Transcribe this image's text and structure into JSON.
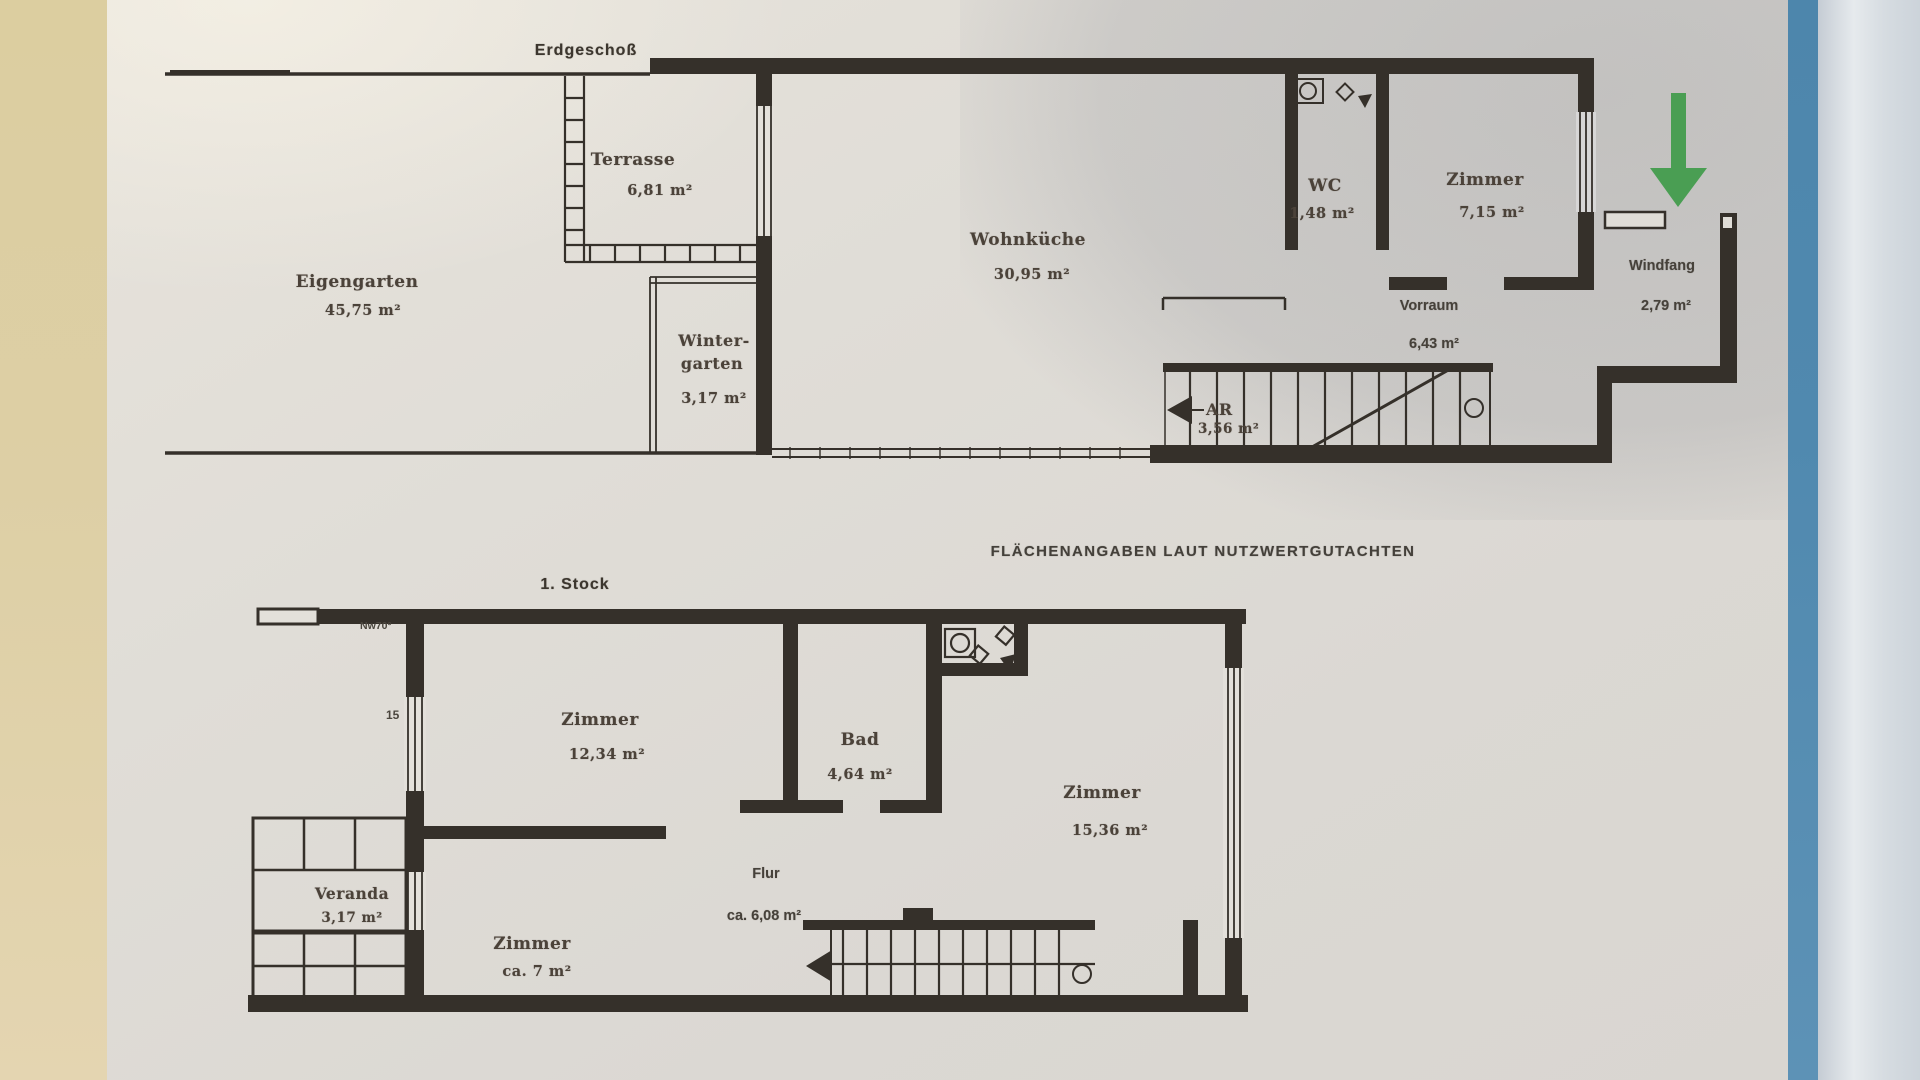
{
  "titles": {
    "ground_floor": "Erdgeschoß",
    "first_floor": "1. Stock",
    "note": "FLÄCHENANGABEN LAUT NUTZWERTGUTACHTEN"
  },
  "ground_floor": {
    "rooms": {
      "terrasse": {
        "name": "Terrasse",
        "area": "6,81 m²"
      },
      "eigengarten": {
        "name": "Eigengarten",
        "area": "45,75 m²"
      },
      "wohnkueche": {
        "name": "Wohnküche",
        "area": "30,95 m²"
      },
      "wintergarten": {
        "name_line1": "Winter-",
        "name_line2": "garten",
        "area": "3,17 m²"
      },
      "wc": {
        "name": "WC",
        "area": "1,48 m²"
      },
      "zimmer": {
        "name": "Zimmer",
        "area": "7,15 m²"
      },
      "vorraum": {
        "name": "Vorraum",
        "area": "6,43 m²"
      },
      "windfang": {
        "name": "Windfang",
        "area": "2,79 m²"
      },
      "abstellraum": {
        "name": "AR",
        "area": "3,56 m²"
      }
    }
  },
  "first_floor": {
    "rooms": {
      "zimmer_1": {
        "name": "Zimmer",
        "area": "12,34 m²"
      },
      "bad": {
        "name": "Bad",
        "area": "4,64 m²"
      },
      "zimmer_2": {
        "name": "Zimmer",
        "area": "15,36 m²"
      },
      "veranda": {
        "name": "Veranda",
        "area": "3,17 m²"
      },
      "zimmer_3": {
        "name": "Zimmer",
        "area": "ca. 7 m²"
      },
      "flur": {
        "name": "Flur",
        "area": "ca. 6,08 m²"
      }
    },
    "annotations": {
      "wall_note": "Nw70°",
      "dim_note": "15"
    }
  },
  "colors": {
    "ink": "#35302a",
    "label_text": "#4b4239",
    "arrow_green": "#4a9e53",
    "blue_strip": "#5089af",
    "desk_beige": "#decfa6",
    "paper": "#e0ddd7"
  }
}
